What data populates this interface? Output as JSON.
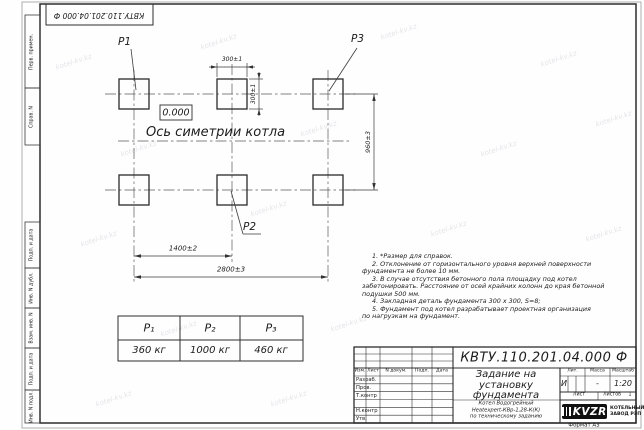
{
  "doc": {
    "number": "КВТУ.110.201.04.000  Ф",
    "number_top": "КВТУ.110.201.04.000  Ф"
  },
  "watermark": "kotel-kv.kz",
  "frame": {
    "left_top_labels": [
      "Перв. примен.",
      "Справ. N"
    ],
    "left_bottom_labels": [
      "Подп. и дата",
      "Инв. N дубл.",
      "Взам. инв. N",
      "Подп. и дата",
      "Инв. N подл."
    ]
  },
  "drawing": {
    "post_labels": [
      "P1",
      "P2",
      "P3"
    ],
    "elevation": "0.000",
    "axis_caption": "Ось симетрии котла",
    "dimensions": {
      "width_top": "300±1",
      "height_side": "300±1",
      "row_spacing": "960±3",
      "col_spacing": "1400±2",
      "total_width": "2800±3"
    }
  },
  "load_table": {
    "headers": [
      "P₁",
      "P₂",
      "P₃"
    ],
    "values": [
      "360 кг",
      "1000 кг",
      "460 кг"
    ]
  },
  "notes": [
    "1.  *Размер для справок.",
    "2.  Отклонение от горизонтального уровня верхней поверхности",
    "фундамента не более 10 мм.",
    "3.  В случае отсутствия бетонного пола площадку под котел",
    "забетонировать. Расстояние от осей крайних колонн до края бетонной",
    "подушки 500 мм.",
    "4.  Закладная деталь фундамента  300 х 300, S=8;",
    "5.  Фундамент под котел разрабатывает проектная организация",
    "по нагрузкам на фундамент."
  ],
  "title_block": {
    "title_lines": [
      "Задание на",
      "установку",
      "фундамента"
    ],
    "subtitle_lines": [
      "Котел Водогрейный",
      "Heatexpert-КВр-1,28-К(К)",
      "по техническому заданию"
    ],
    "col_headers": [
      "Изм.",
      "Лист",
      "N докум.",
      "Подп.",
      "Дата"
    ],
    "row_labels": [
      "Разраб.",
      "Пров.",
      "Т.контр",
      "Н.контр",
      "Утв."
    ],
    "props": {
      "lit_label": "Лит.",
      "mass_label": "Масса",
      "scale_label": "Масштаб",
      "lit": "И",
      "mass": "-",
      "scale": "1:20",
      "sheet_label": "Лист",
      "sheets_label": "Листов",
      "sheets_count": "1"
    },
    "brand": {
      "logo": "KVZR",
      "company_line1": "КОТЕЛЬНЫЙ",
      "company_line2": "ЗАВОД РЭП"
    },
    "format": "Формат А3"
  }
}
